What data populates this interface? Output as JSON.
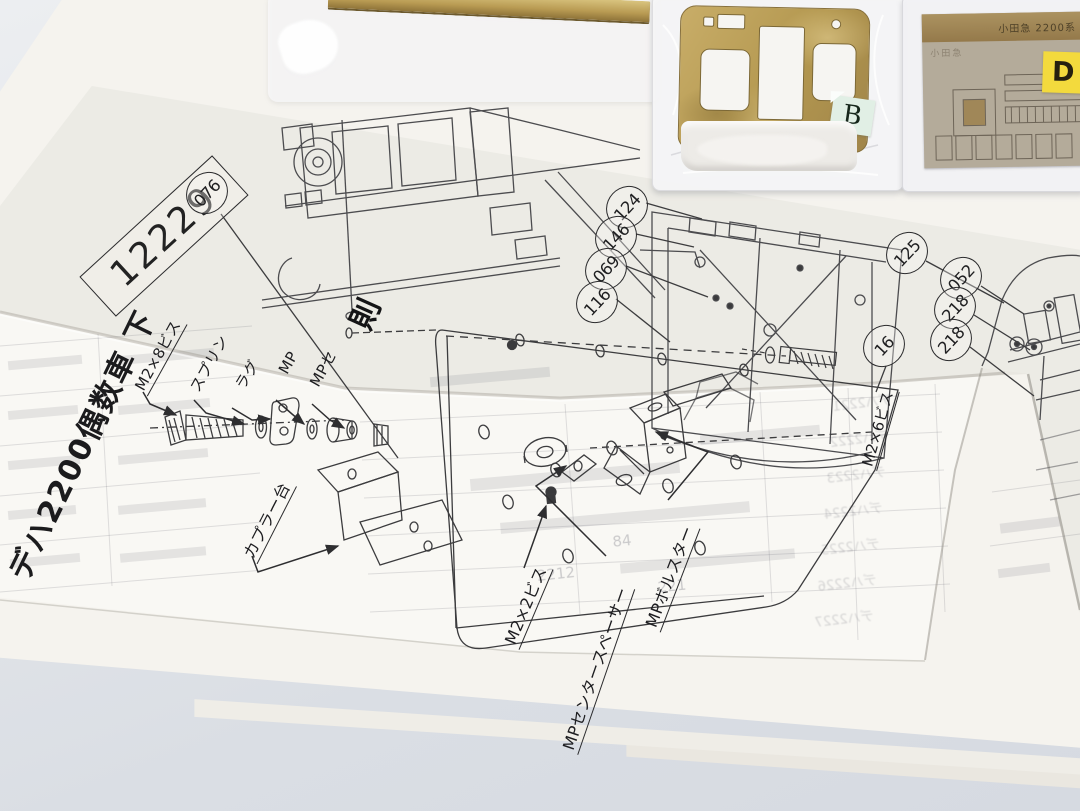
{
  "sheet": {
    "serial": "12229",
    "title": "デハ2200偶数車 下",
    "fold_char": "則"
  },
  "callouts": [
    "076",
    "124",
    "146",
    "069",
    "116",
    "125",
    "052",
    "218",
    "218",
    "16"
  ],
  "labels": {
    "m2x8": "M2×8ビス",
    "spring": "スプリン",
    "lug": "ラグ",
    "mp_a": "MP",
    "mp_b": "MPセ",
    "coupler_base": "カプラー台",
    "m2x2": "M2×2ビス",
    "center_spacer": "MPセンタースペーサー",
    "bolster": "MPボルスター",
    "m2x6": "M2×6ビス"
  },
  "packages": {
    "panel_sticker": "B",
    "etch_sticker": "D",
    "etch_plate_text": "小田急 2200系",
    "etch_plate_text2": "小田急"
  },
  "ghost": {
    "n1": "2212",
    "n2": "221",
    "n3": "84",
    "cars": [
      "デハ2221",
      "デハ2222",
      "デハ2223",
      "デハ2224",
      "デハ2225",
      "デハ2226",
      "デハ2227"
    ]
  },
  "colors": {
    "table": "#dde0e6",
    "paper": "#f9f8f4",
    "paper-tint": "#edece7",
    "ink": "#3f3f42",
    "brass": "#b89e5f",
    "etch": "#b2a896",
    "sticker-b": "#e1efe5",
    "sticker-d": "#f3da3d"
  }
}
